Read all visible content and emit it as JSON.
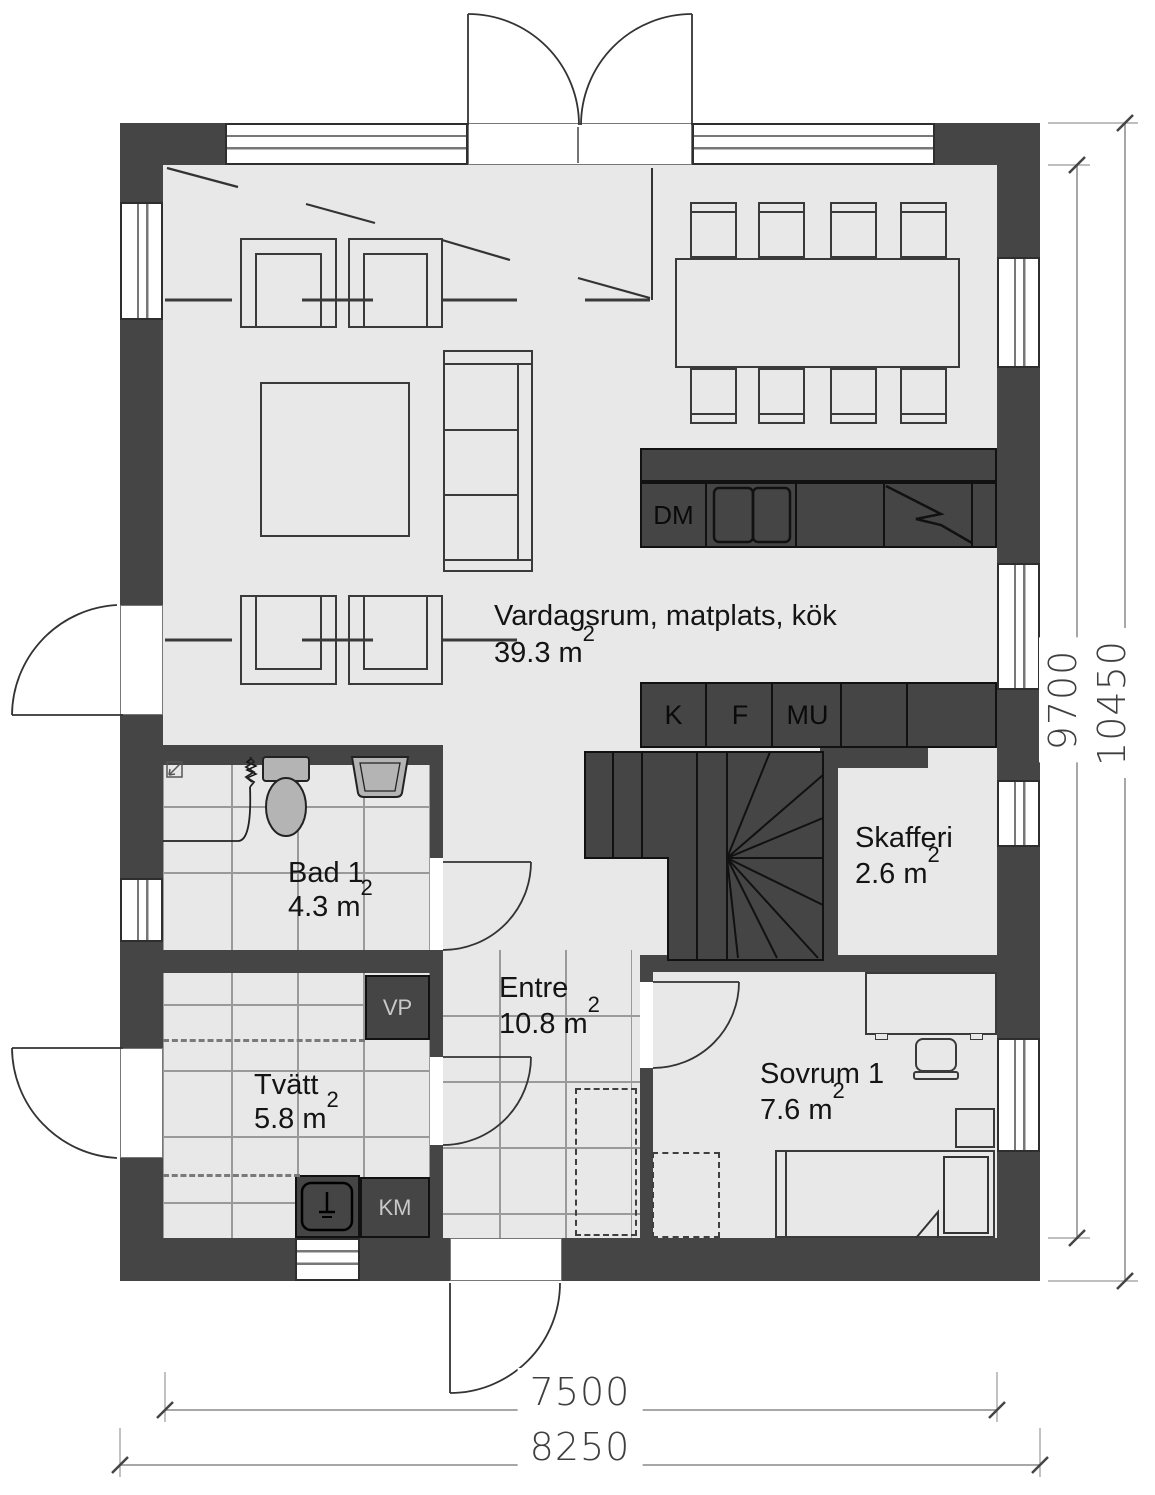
{
  "plan": {
    "title": "Floor plan – entry level",
    "rooms": {
      "vardagsrum": {
        "name": "Vardagsrum, matplats, kök",
        "area": "39.3 m",
        "sup": "2"
      },
      "bad1": {
        "name": "Bad 1",
        "area": "4.3 m",
        "sup": "2"
      },
      "tvatt": {
        "name": "Tvätt",
        "area": "5.8 m",
        "sup": "2"
      },
      "entre": {
        "name": "Entre",
        "area": "10.8 m",
        "sup": "2"
      },
      "sovrum1": {
        "name": "Sovrum 1",
        "area": "7.6 m",
        "sup": "2"
      },
      "skafferi": {
        "name": "Skafferi",
        "area": "2.6 m",
        "sup": "2"
      }
    },
    "appliances": {
      "dm": "DM",
      "k": "K",
      "f": "F",
      "mu": "MU",
      "vp": "VP",
      "km": "KM"
    },
    "dimensions": {
      "right_inner": "9700",
      "right_outer": "10450",
      "bottom_inner": "7500",
      "bottom_outer": "8250"
    },
    "colors": {
      "wall": "#454545",
      "floor": "#e8e8e8",
      "fixture": "#b4b4b4",
      "tile_line": "#9a9a9a",
      "dim_line": "#8a8a8a"
    }
  }
}
